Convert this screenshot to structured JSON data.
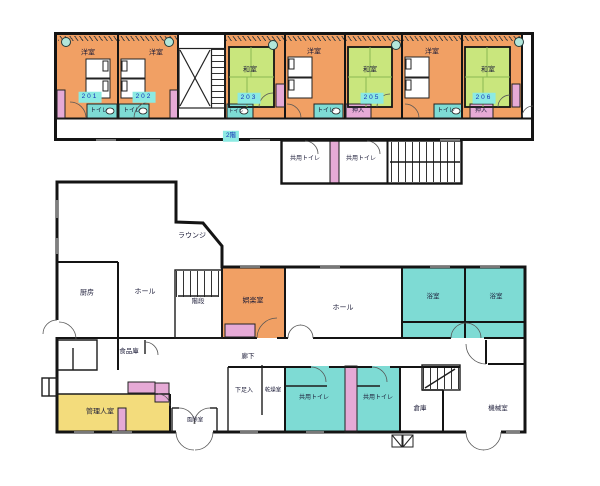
{
  "palette": {
    "room_orange": "#f1a064",
    "tatami_green": "#c9e67d",
    "wet_cyan": "#7edbd4",
    "closet_pink": "#e6aad6",
    "manager_yellow": "#f3dc7c",
    "badge_cyan": "#8ceae2",
    "wall_black": "#141414"
  },
  "floor2": {
    "badge": "2階",
    "room201": {
      "type": "洋室",
      "num": "201",
      "toilet": "トイレ"
    },
    "room202": {
      "type": "洋室",
      "num": "202",
      "toilet": "トイレ"
    },
    "room203": {
      "type": "和室",
      "num": "203",
      "toilet": "トイレ"
    },
    "room204": {
      "type": "洋室",
      "toilet": "トイレ"
    },
    "room205": {
      "type": "和室",
      "num": "205",
      "oshiire": "押入"
    },
    "room206w": {
      "type": "洋室",
      "toilet": "トイレ"
    },
    "room206": {
      "type": "和室",
      "num": "206",
      "oshiire": "押入"
    },
    "shared_toilet_1": "共用トイレ",
    "shared_toilet_2": "共用トイレ"
  },
  "floor1": {
    "lounge": "ラウンジ",
    "kitchen": "厨房",
    "hall_left": "ホール",
    "stairs": "階段",
    "rec_room": "娯楽室",
    "hall": "ホール",
    "bath_1": "浴室",
    "bath_2": "浴室",
    "pantry": "食品庫",
    "corridor": "廊下",
    "manager_room": "管理人室",
    "windbreak": "風除室",
    "shoe_storage": "下足入",
    "drying_room": "乾燥室",
    "shared_toilet_1": "共用トイレ",
    "shared_toilet_2": "共用トイレ",
    "storage": "倉庫",
    "machine_room": "機械室"
  }
}
